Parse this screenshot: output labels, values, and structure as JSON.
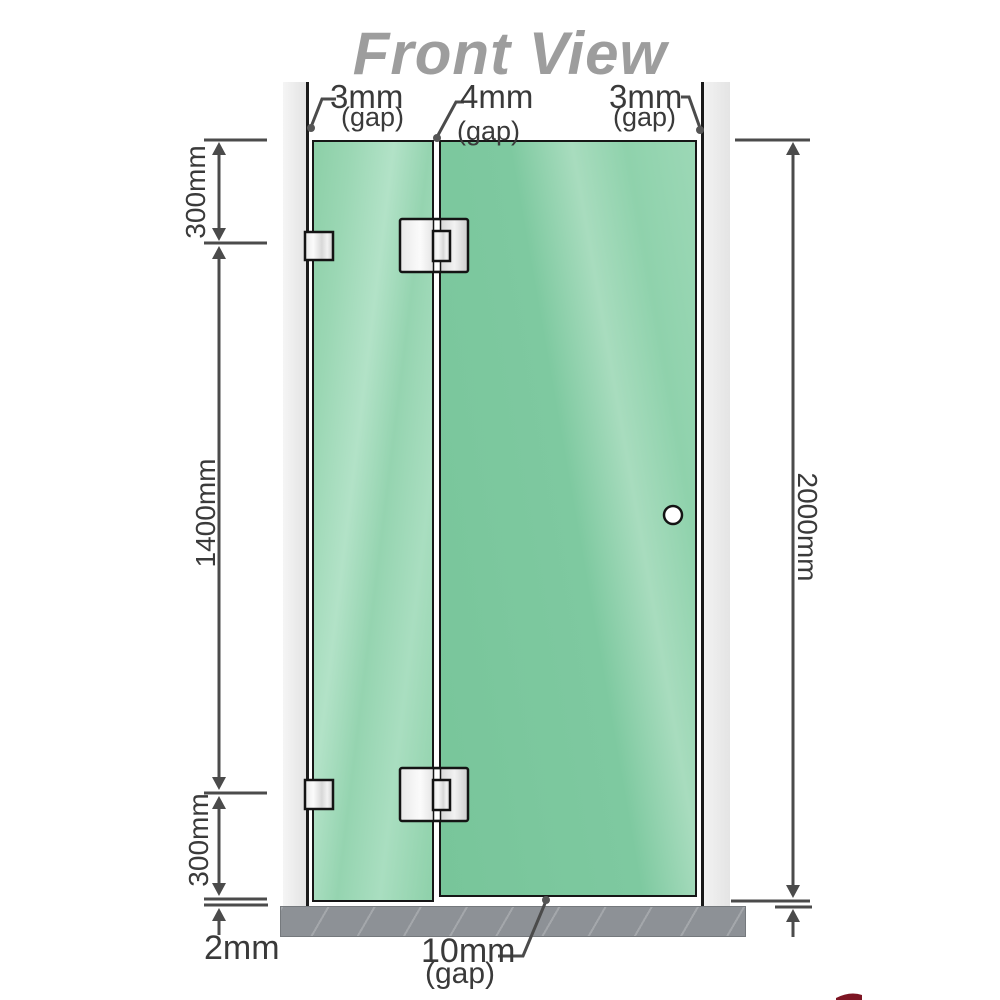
{
  "title": "Front View",
  "labels": {
    "gap_top_left": "3mm",
    "gap_top_left_note": "(gap)",
    "gap_top_middle": "4mm",
    "gap_top_middle_note": "(gap)",
    "gap_top_right": "3mm",
    "gap_top_right_note": "(gap)",
    "dim_left_top": "300mm",
    "dim_left_middle": "1400mm",
    "dim_left_bottom": "300mm",
    "dim_floor": "2mm",
    "dim_right": "2000mm",
    "gap_bottom": "10mm",
    "gap_bottom_note": "(gap)"
  },
  "colors": {
    "glass_green": "#7ec9a0",
    "glass_highlight": "#a9dec2",
    "wall_grey": "#ededed",
    "floor_grey": "#8d9196",
    "line_grey": "#4b4b4b",
    "label_text": "#3a3a3a",
    "title_grey": "#9d9d9d",
    "hardware_metal": "#e9e9e9",
    "logo_red": "#7d1523"
  },
  "icons": {
    "door_handle": "circle-knob"
  }
}
